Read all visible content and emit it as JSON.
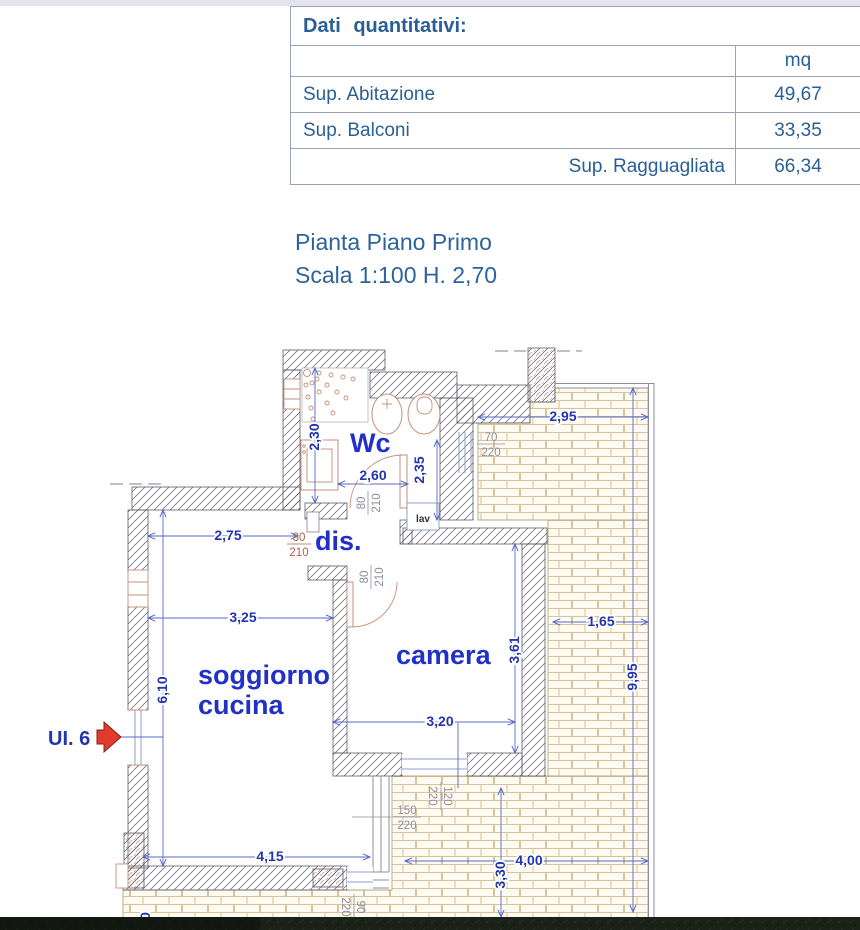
{
  "table": {
    "title": "Dati quantitativi:",
    "unit_header": "mq",
    "rows": [
      {
        "label": "Sup. Abitazione",
        "value": "49,67"
      },
      {
        "label": "Sup. Balconi",
        "value": "33,35"
      },
      {
        "label": "Sup. Ragguagliata",
        "value": "66,34"
      }
    ]
  },
  "plan_title": {
    "line1": "Pianta Piano Primo",
    "line2": "Scala 1:100 H. 2,70"
  },
  "unit_label": "UI. 6",
  "rooms": {
    "wc": "Wc",
    "dis": "dis.",
    "camera": "camera",
    "soggiorno_line1": "soggiorno",
    "soggiorno_line2": "cucina",
    "lav": "lav"
  },
  "dimensions": {
    "balcony_top_width": "2,95",
    "wc_depth": "2,30",
    "wc_right_depth": "2,35",
    "wc_width": "2,60",
    "dis_width": "2,75",
    "soggiorno_width": "3,25",
    "camera_depth": "3,61",
    "balcony_right_width": "1,65",
    "balcony_right_length": "9,95",
    "soggiorno_depth": "6,10",
    "camera_width": "3,20",
    "soggiorno_bottom_width": "4,15",
    "balcony_bottom_width": "4,00",
    "balcony_bottom_depth": "3,30",
    "edge_partial": "0"
  },
  "openings": {
    "wc_door": {
      "w": "80",
      "h": "210"
    },
    "soggiorno_door": {
      "w": "80",
      "h": "210"
    },
    "camera_door": {
      "w": "80",
      "h": "210"
    },
    "balcony_top_window": {
      "w": "70",
      "h": "220"
    },
    "camera_window": {
      "w": "150",
      "h": "220"
    },
    "camera_side_window": {
      "w": "120",
      "h": "220"
    },
    "balcony_bottom_opening": {
      "w": "90",
      "h": "220"
    }
  },
  "colors": {
    "table_text": "#2a5f96",
    "dim_text": "#2336ad",
    "room_text": "#2130c8",
    "tag_gray": "#8e8e9e",
    "tag_brown": "#a8614a",
    "arrow_red": "#e03c2d",
    "wall_line": "#5c5c66",
    "brick_line": "#cdbb92"
  }
}
